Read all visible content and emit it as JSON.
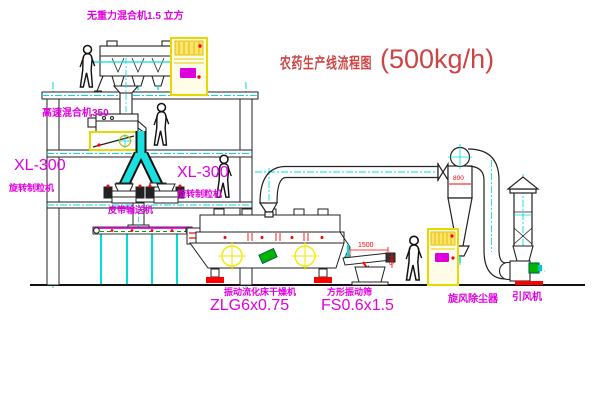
{
  "title": {
    "text": "农药生产线流程图",
    "capacity": "(500kg/h)"
  },
  "equipment_labels": {
    "gravity_mixer": "无重力混合机1.5 立方",
    "high_speed_mixer": "高速混合机350",
    "granulator_left": {
      "model": "XL-300",
      "name": "旋转制粒机"
    },
    "granulator_right": {
      "model": "XL-300",
      "name": "旋转制粒机"
    },
    "belt_conveyor": "皮带输送机",
    "fluid_bed_dryer": {
      "name": "振动流化床干燥机",
      "model": "ZLG6x0.75"
    },
    "vibrating_screen": {
      "name": "方形振动筛",
      "model": "FS0.6x1.5"
    },
    "cyclone": "旋风除尘器",
    "induced_draft_fan": "引风机"
  },
  "dimensions": {
    "cyclone_inlet": "800",
    "screen_length": "1500",
    "screen_height": "745"
  },
  "colors": {
    "label_magenta": "#e000e0",
    "title_red": "#cc4444",
    "dim_red": "#ff0000",
    "centerline_cyan": "#00dddd",
    "cabinet_yellow": "#f0e000",
    "machine_green": "#00b400"
  }
}
